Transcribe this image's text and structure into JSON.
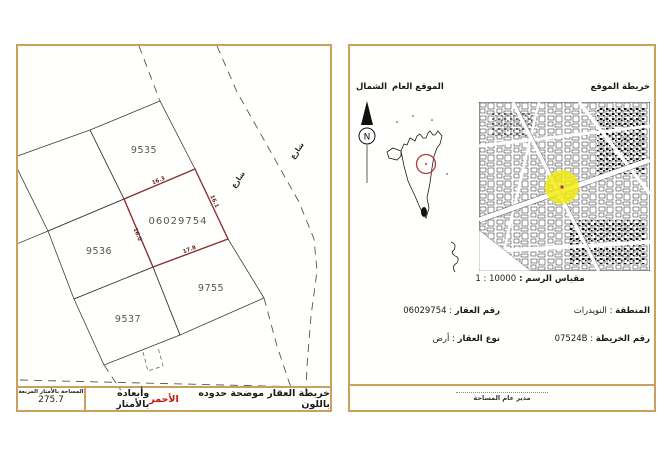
{
  "left_panel": {
    "plots": [
      "9535",
      "9536",
      "9537",
      "9755"
    ],
    "subject_parcel": {
      "number": "06029754",
      "dimensions": {
        "top": "16.3",
        "right": "16.1",
        "left": "16.0",
        "bottom": "17.8"
      }
    },
    "street_label": "شارع",
    "footer": {
      "area_label": "المساحة بالأمتار المربعة",
      "area_value": "275.7",
      "note_before": "خريطة العقار موضحة حدوده باللون ",
      "note_red": "الأحمر",
      "note_after": " وأبعاده بالأمتار"
    }
  },
  "right_panel": {
    "north_label": "الشمال",
    "compass_letter": "N",
    "general_location_label": "الموقع العام",
    "site_map_label": "خريطة الموقع",
    "scale_label": "مقياس الرسم :",
    "scale_value": "1 : 10000",
    "separator": ":",
    "fields_left": [
      {
        "label": "رقم العقار",
        "value": "06029754"
      },
      {
        "label": "نوع العقار",
        "value": "أرض"
      }
    ],
    "fields_right": [
      {
        "label": "المنطقة",
        "value": "النويدرات"
      },
      {
        "label": "رقم الخريطة",
        "value": "07524B"
      }
    ],
    "signature_label": "مدير عام المساحة"
  },
  "colors": {
    "panel_border": "#c9a15c",
    "parcel_outline": "#8f3032",
    "highlight_circle": "#f2ea0a",
    "location_ring": "#b23a3a"
  }
}
